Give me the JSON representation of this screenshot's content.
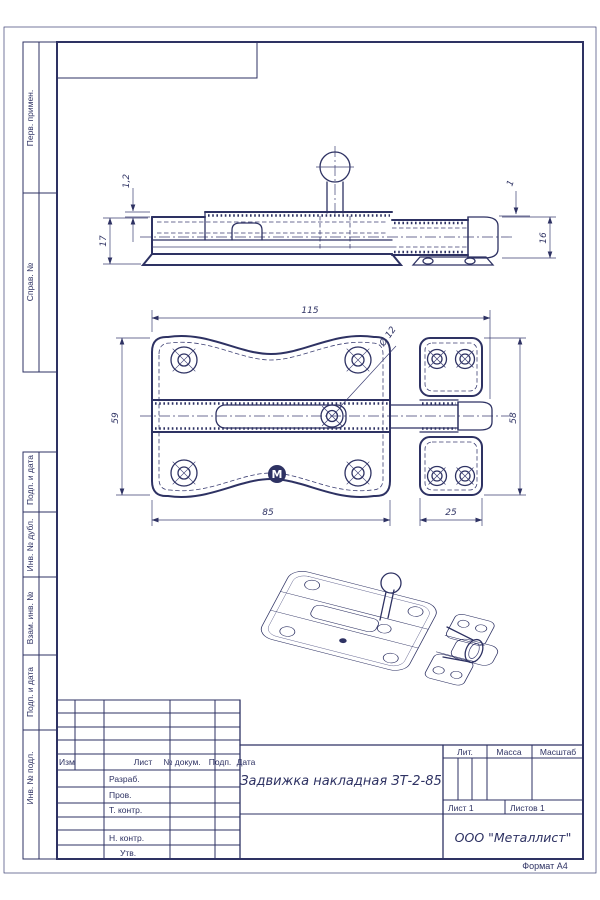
{
  "colors": {
    "line": "#2e3263"
  },
  "margin_labels": [
    "Перв. примен.",
    "Справ. №",
    "Подп. и дата",
    "Инв. № дубл.",
    "Взам. инв. №",
    "Подп. и дата",
    "Инв. № подл."
  ],
  "title_block": {
    "rev_header": {
      "izm": "Изм",
      "list": "Лист",
      "dokum": "№ докум.",
      "podp": "Подп.",
      "data": "Дата"
    },
    "roles": {
      "razrab": "Разраб.",
      "prov": "Пров.",
      "tkontr": "Т. контр.",
      "nkontr": "Н. контр.",
      "utv": "Утв."
    },
    "doc_title": "Задвижка накладная ЗТ-2-85",
    "lit": "Лит.",
    "massa": "Масса",
    "masshtab": "Масштаб",
    "sheet": "Лист 1",
    "sheets": "Листов 1",
    "company": "ООО \"Металлист\"",
    "format": "Формат А4"
  },
  "dims": {
    "side": {
      "d12": "1,2",
      "d17": "17",
      "d1": "1",
      "d16": "16"
    },
    "plan": {
      "d115": "115",
      "dia12": "Ø 12",
      "d59": "59",
      "d58": "58",
      "d85": "85",
      "d25": "25"
    }
  },
  "logo_letter": "М"
}
